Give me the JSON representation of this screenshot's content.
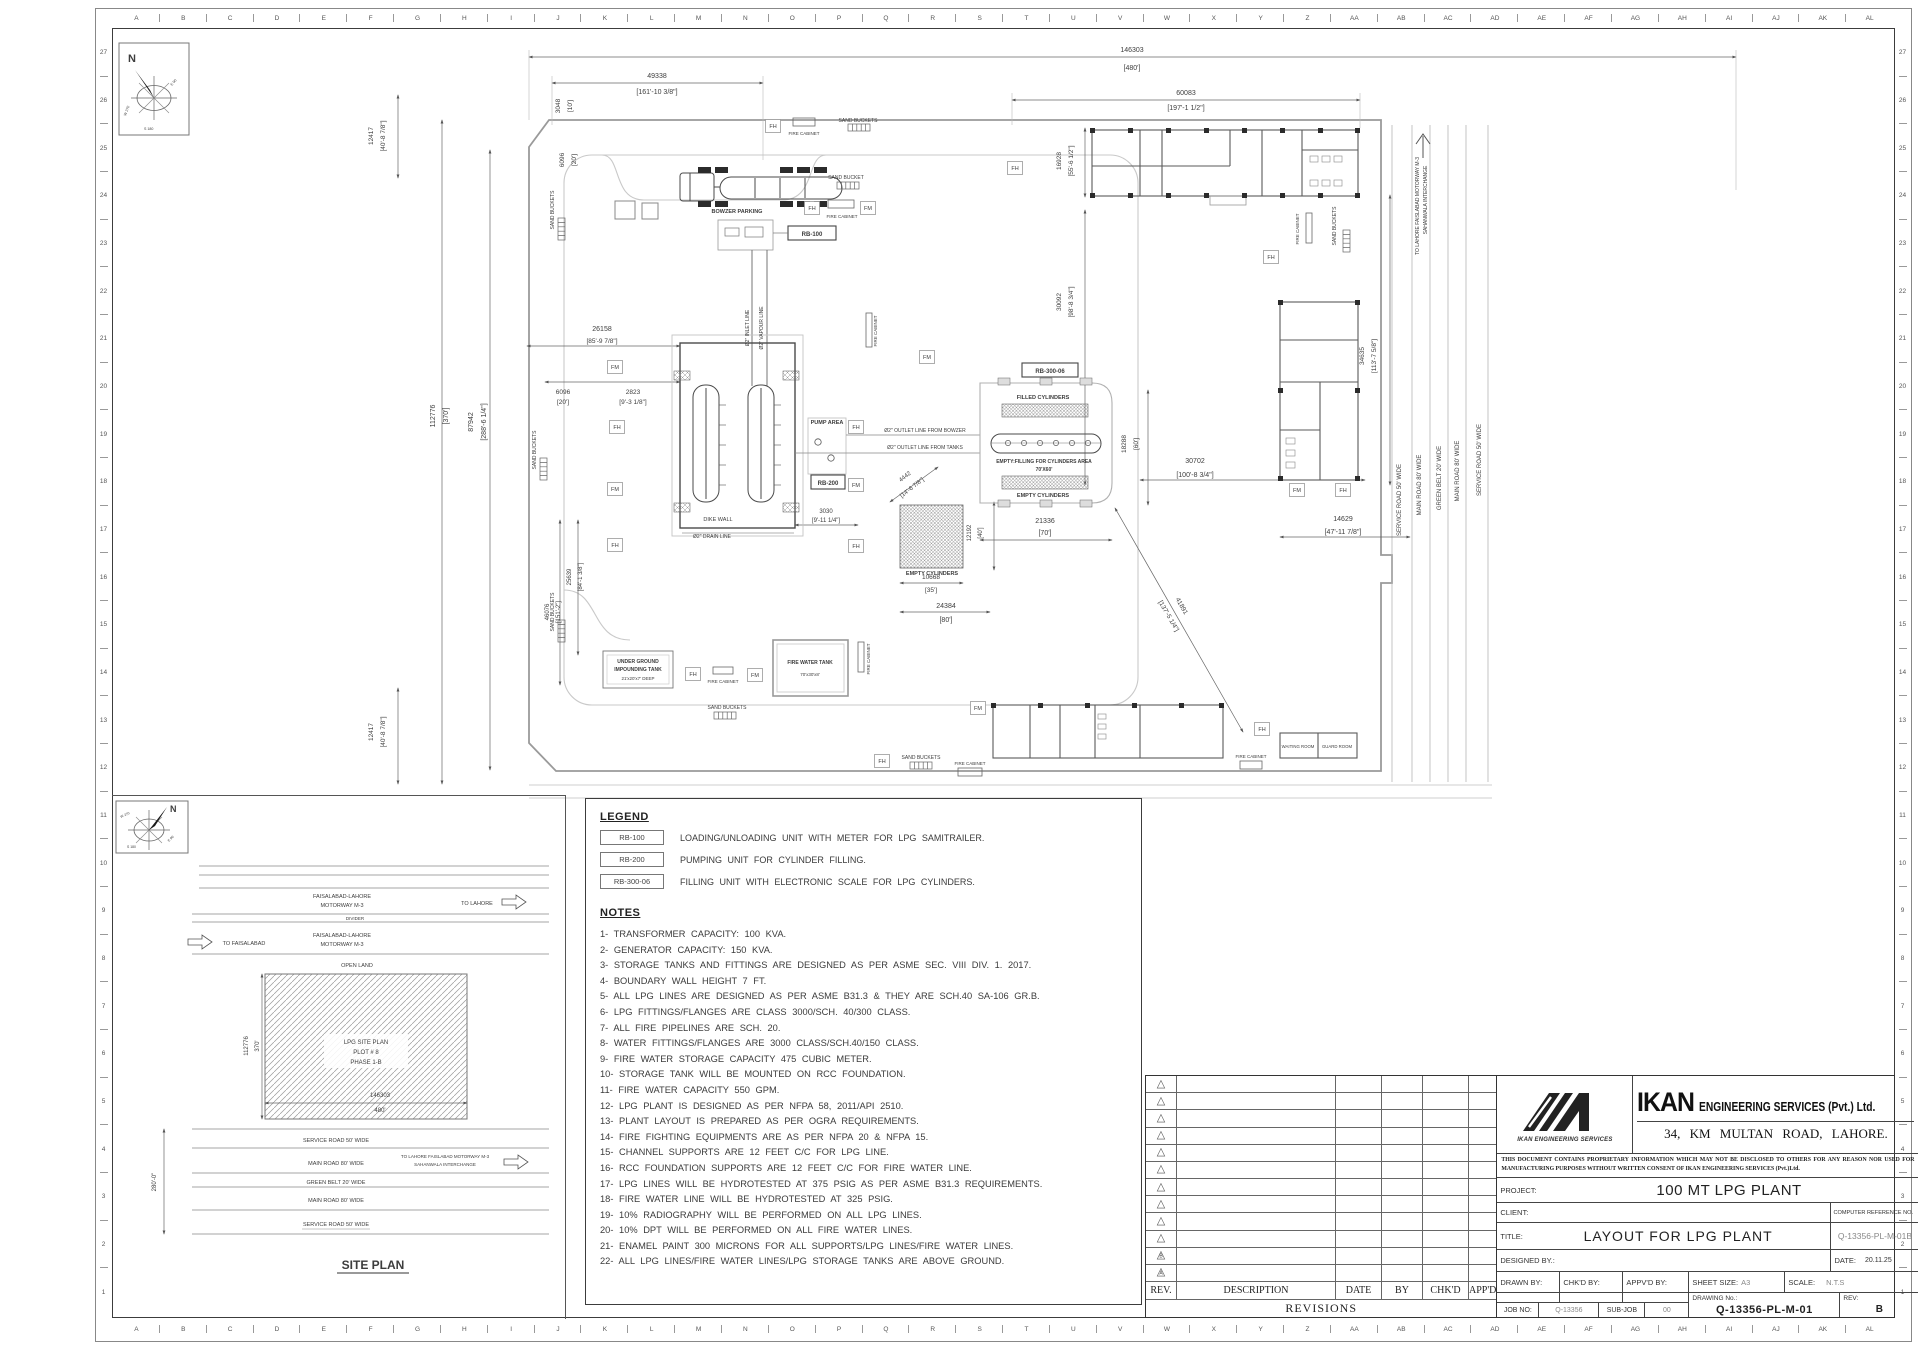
{
  "sheet": {
    "grid_letters": [
      "A",
      "B",
      "C",
      "D",
      "E",
      "F",
      "G",
      "H",
      "I",
      "J",
      "K",
      "L",
      "M",
      "N",
      "O",
      "P",
      "Q",
      "R",
      "S",
      "T",
      "U",
      "V",
      "W",
      "X",
      "Y",
      "Z",
      "AA",
      "AB",
      "AC",
      "AD",
      "AE",
      "AF",
      "AG",
      "AH",
      "AI",
      "AJ",
      "AK",
      "AL"
    ],
    "grid_numbers": [
      "27",
      "26",
      "25",
      "24",
      "23",
      "22",
      "21",
      "20",
      "19",
      "18",
      "17",
      "16",
      "15",
      "14",
      "13",
      "12",
      "11",
      "10",
      "9",
      "8",
      "7",
      "6",
      "5",
      "4",
      "3",
      "2",
      "1"
    ]
  },
  "compass": {
    "n": "N",
    "w": "W 270",
    "s": "S 180",
    "e": "E 90"
  },
  "legend": {
    "title": "LEGEND",
    "items": [
      {
        "code": "RB-100",
        "desc": "LOADING/UNLOADING UNIT WITH METER FOR LPG SAMITRAILER."
      },
      {
        "code": "RB-200",
        "desc": "PUMPING UNIT FOR CYLINDER FILLING."
      },
      {
        "code": "RB-300-06",
        "desc": "FILLING UNIT WITH ELECTRONIC SCALE FOR LPG CYLINDERS."
      }
    ]
  },
  "notes": {
    "title": "NOTES",
    "items": [
      "1-  TRANSFORMER  CAPACITY:  100  KVA.",
      "2-  GENERATOR  CAPACITY:  150  KVA.",
      "3-  STORAGE  TANKS  AND  FITTINGS  ARE  DESIGNED  AS  PER  ASME  SEC.  VIII  DIV.  1.  2017.",
      "4-  BOUNDARY  WALL  HEIGHT  7  FT.",
      "5-  ALL  LPG  LINES  ARE  DESIGNED  AS  PER  ASME  B31.3  &  THEY  ARE  SCH.40  SA-106  GR.B.",
      "6-  LPG  FITTINGS/FLANGES  ARE  CLASS  3000/SCH.  40/300  CLASS.",
      "7-  ALL  FIRE  PIPELINES  ARE  SCH.  20.",
      "8-  WATER  FITTINGS/FLANGES  ARE  3000  CLASS/SCH.40/150  CLASS.",
      "9-  FIRE  WATER  STORAGE  CAPACITY  475  CUBIC  METER.",
      "10-  STORAGE  TANK  WILL  BE  MOUNTED  ON  RCC  FOUNDATION.",
      "11-  FIRE  WATER  CAPACITY  550  GPM.",
      "12-  LPG  PLANT  IS  DESIGNED  AS  PER  NFPA  58,  2011/API  2510.",
      "13-  PLANT  LAYOUT  IS  PREPARED  AS  PER  OGRA  REQUIREMENTS.",
      "14-  FIRE  FIGHTING  EQUIPMENTS  ARE  AS  PER  NFPA  20  &  NFPA  15.",
      "15-  CHANNEL  SUPPORTS  ARE  12  FEET  C/C  FOR  LPG  LINE.",
      "16-  RCC  FOUNDATION  SUPPORTS  ARE  12  FEET  C/C  FOR  FIRE  WATER  LINE.",
      "17-  LPG  LINES  WILL  BE  HYDROTESTED  AT  375  PSIG  AS  PER  ASME  B31.3  REQUIREMENTS.",
      "18-  FIRE  WATER  LINE  WILL  BE  HYDROTESTED  AT  325  PSIG.",
      "19-  10%  RADIOGRAPHY  WILL  BE  PERFORMED  ON  ALL  LPG  LINES.",
      "20-  10%  DPT  WILL  BE  PERFORMED  ON  ALL  FIRE  WATER  LINES.",
      "21-  ENAMEL  PAINT  300  MICRONS  FOR  ALL  SUPPORTS/LPG  LINES/FIRE  WATER  LINES.",
      "22-  ALL  LPG  LINES/FIRE  WATER  LINES/LPG  STORAGE  TANKS  ARE  ABOVE  GROUND."
    ]
  },
  "revisions": {
    "caption": "REVISIONS",
    "headers": [
      "REV.",
      "DESCRIPTION",
      "DATE",
      "BY",
      "CHK'D",
      "APP'D"
    ],
    "rows": [
      "",
      "",
      "",
      "",
      "",
      "",
      "",
      "",
      "",
      "",
      "B",
      "A"
    ]
  },
  "title_block": {
    "company_strong": "IKAN",
    "company_rest": "ENGINEERING SERVICES (Pvt.) Ltd.",
    "logo_caption": "IKAN ENGINEERING SERVICES",
    "address": "34, KM MULTAN ROAD, LAHORE.",
    "disclaimer": "THIS DOCUMENT CONTAINS PROPRIETARY INFORMATION WHICH MAY NOT BE DISCLOSED TO OTHERS FOR ANY REASON NOR USED FOR MANUFACTURING PURPOSES WITHOUT WRITTEN CONSENT OF IKAN ENGINEERING SERVICES (Pvt.)Ltd.",
    "project_label": "PROJECT:",
    "project_value": "100 MT LPG PLANT",
    "client_label": "CLIENT:",
    "computer_ref_label": "COMPUTER REFERENCE NO.",
    "computer_ref_value": "Q-13356-PL-M-01B",
    "title_label": "TITLE:",
    "title_value": "LAYOUT FOR LPG PLANT",
    "designed_label": "DESIGNED BY.:",
    "date_label": "DATE:",
    "date_value": "20.11.25",
    "drawn_label": "DRAWN BY:",
    "chkd_label": "CHK'D BY:",
    "appvd_label": "APPV'D BY:",
    "sheet_size_label": "SHEET SIZE:",
    "sheet_size_value": "A3",
    "scale_label": "SCALE:",
    "scale_value": "N.T.S",
    "job_no_label": "JOB NO:",
    "job_no_value": "Q-13356",
    "sub_job_label": "SUB-JOB",
    "sub_job_value": "00",
    "drawing_no_label": "DRAWING No.:",
    "drawing_no_value": "Q-13356-PL-M-01",
    "rev_label": "REV:",
    "rev_value": "B"
  },
  "plan": {
    "texts": [
      {
        "t": "146303",
        "x": 782,
        "y": 22
      },
      {
        "t": "[480']",
        "x": 782,
        "y": 40
      },
      {
        "t": "49338",
        "x": 307,
        "y": 48
      },
      {
        "t": "[161'-10 3/8\"]",
        "x": 307,
        "y": 64
      },
      {
        "t": "60083",
        "x": 836,
        "y": 65
      },
      {
        "t": "[197'-1 1/2\"]",
        "x": 836,
        "y": 80
      },
      {
        "t": "3048",
        "x": 210,
        "y": 76,
        "r": -90,
        "s": 6.5
      },
      {
        "t": "[10']",
        "x": 222,
        "y": 76,
        "r": -90,
        "s": 6.5
      },
      {
        "t": "6096",
        "x": 214,
        "y": 130,
        "r": -90,
        "s": 6.5
      },
      {
        "t": "[20']",
        "x": 226,
        "y": 130,
        "r": -90,
        "s": 6.5
      },
      {
        "t": "12417",
        "x": 23,
        "y": 106,
        "r": -90,
        "s": 6.5
      },
      {
        "t": "[40'-8 7/8\"]",
        "x": 35,
        "y": 106,
        "r": -90,
        "s": 6.5
      },
      {
        "t": "112776",
        "x": 85,
        "y": 386,
        "r": -90
      },
      {
        "t": "[370']",
        "x": 98,
        "y": 386,
        "r": -90
      },
      {
        "t": "87942",
        "x": 123,
        "y": 392,
        "r": -90
      },
      {
        "t": "[288'-6 1/4\"]",
        "x": 136,
        "y": 392,
        "r": -90
      },
      {
        "t": "16928",
        "x": 711,
        "y": 131,
        "r": -90,
        "s": 6.5
      },
      {
        "t": "[55'-6 1/2\"]",
        "x": 723,
        "y": 131,
        "r": -90,
        "s": 6.5
      },
      {
        "t": "30092",
        "x": 711,
        "y": 272,
        "r": -90,
        "s": 6.5
      },
      {
        "t": "[98'-8 3/4\"]",
        "x": 723,
        "y": 272,
        "r": -90,
        "s": 6.5
      },
      {
        "t": "26158",
        "x": 252,
        "y": 301
      },
      {
        "t": "[85'-9 7/8\"]",
        "x": 252,
        "y": 313,
        "s": 6.5
      },
      {
        "t": "6096",
        "x": 213,
        "y": 364,
        "s": 6.5
      },
      {
        "t": "[20']",
        "x": 213,
        "y": 374,
        "s": 6.5
      },
      {
        "t": "2823",
        "x": 283,
        "y": 364,
        "s": 6.5
      },
      {
        "t": "[9'-3 1/8\"]",
        "x": 283,
        "y": 374,
        "s": 6.5
      },
      {
        "t": "46076",
        "x": 199,
        "y": 582,
        "r": -90,
        "s": 6
      },
      {
        "t": "[151'-2\"]",
        "x": 210,
        "y": 582,
        "r": -90,
        "s": 6
      },
      {
        "t": "25639",
        "x": 221,
        "y": 547,
        "r": -90,
        "s": 6
      },
      {
        "t": "[84'-1 3/8\"]",
        "x": 232,
        "y": 547,
        "r": -90,
        "s": 6
      },
      {
        "t": "12417",
        "x": 23,
        "y": 702,
        "r": -90,
        "s": 6.5
      },
      {
        "t": "[40'-8 7/8\"]",
        "x": 35,
        "y": 702,
        "r": -90,
        "s": 6.5
      },
      {
        "t": "34635",
        "x": 1014,
        "y": 326,
        "r": -90,
        "s": 6.5
      },
      {
        "t": "[113'-7 5/8\"]",
        "x": 1026,
        "y": 326,
        "r": -90,
        "s": 6.5
      },
      {
        "t": "18288",
        "x": 776,
        "y": 414,
        "r": -90,
        "s": 6.5
      },
      {
        "t": "[60']",
        "x": 788,
        "y": 414,
        "r": -90,
        "s": 6.5
      },
      {
        "t": "30702",
        "x": 845,
        "y": 433
      },
      {
        "t": "[100'-8 3/4\"]",
        "x": 845,
        "y": 447
      },
      {
        "t": "21336",
        "x": 695,
        "y": 493
      },
      {
        "t": "[70']",
        "x": 695,
        "y": 505
      },
      {
        "t": "14629",
        "x": 993,
        "y": 491
      },
      {
        "t": "[47'-11 7/8\"]",
        "x": 993,
        "y": 504
      },
      {
        "t": "10668",
        "x": 581,
        "y": 549,
        "s": 6.5
      },
      {
        "t": "[35']",
        "x": 581,
        "y": 562,
        "s": 6.5
      },
      {
        "t": "24384",
        "x": 596,
        "y": 578
      },
      {
        "t": "[80']",
        "x": 596,
        "y": 592
      },
      {
        "t": "12192",
        "x": 621,
        "y": 503,
        "r": -90,
        "s": 6
      },
      {
        "t": "[40']",
        "x": 632,
        "y": 503,
        "r": -90,
        "s": 6
      },
      {
        "t": "4442",
        "x": 556,
        "y": 448,
        "r": -38,
        "s": 6
      },
      {
        "t": "[14'-6 7/8\"]",
        "x": 563,
        "y": 459,
        "r": -38,
        "s": 6
      },
      {
        "t": "3030",
        "x": 476,
        "y": 483,
        "s": 6
      },
      {
        "t": "[9'-11 1/4\"]",
        "x": 476,
        "y": 492,
        "s": 6
      },
      {
        "t": "41891",
        "x": 830,
        "y": 577,
        "r": 60,
        "s": 6.5
      },
      {
        "t": "[137'-5 1/4\"]",
        "x": 817,
        "y": 587,
        "r": 60,
        "s": 6.5
      },
      {
        "t": "BOWZER PARKING",
        "x": 387,
        "y": 183,
        "s": 5.5,
        "b": 1
      },
      {
        "t": "RB-100",
        "x": 462,
        "y": 206,
        "s": 6,
        "b": 1
      },
      {
        "t": "RB-200",
        "x": 478,
        "y": 455,
        "s": 6,
        "b": 1
      },
      {
        "t": "RB-300-06",
        "x": 700,
        "y": 343,
        "s": 6,
        "b": 1
      },
      {
        "t": "PUMP AREA",
        "x": 477,
        "y": 394,
        "s": 5.5,
        "b": 1
      },
      {
        "t": "Ø2\" OUTLET LINE FROM BOWZER",
        "x": 575,
        "y": 402,
        "s": 5
      },
      {
        "t": "Ø2\" OUTLET LINE FROM TANKS",
        "x": 575,
        "y": 419,
        "s": 5
      },
      {
        "t": "Ø2\" INLET LINE",
        "x": 399,
        "y": 298,
        "r": -90,
        "s": 5
      },
      {
        "t": "Ø2\" VAPOUR LINE",
        "x": 413,
        "y": 298,
        "r": -90,
        "s": 5
      },
      {
        "t": "Ø2\" DRAIN LINE",
        "x": 362,
        "y": 508,
        "s": 5
      },
      {
        "t": "DIKE WALL",
        "x": 368,
        "y": 491,
        "s": 5.5
      },
      {
        "t": "FILLED CYLINDERS",
        "x": 693,
        "y": 369,
        "s": 5.5,
        "b": 1
      },
      {
        "t": "EMPTY:FILLING FOR CYLINDERS AREA",
        "x": 694,
        "y": 433,
        "s": 5,
        "b": 1
      },
      {
        "t": "70'X60'",
        "x": 694,
        "y": 441,
        "s": 5,
        "b": 1
      },
      {
        "t": "EMPTY CYLINDERS",
        "x": 693,
        "y": 467,
        "s": 5.5,
        "b": 1
      },
      {
        "t": "EMPTY CYLINDERS",
        "x": 582,
        "y": 545,
        "s": 5.5,
        "b": 1
      },
      {
        "t": "UNDER GROUND",
        "x": 288,
        "y": 633,
        "s": 5,
        "b": 1
      },
      {
        "t": "IMPOUNDING TANK",
        "x": 288,
        "y": 641,
        "s": 5,
        "b": 1
      },
      {
        "t": "21'x20'x7' DEEP",
        "x": 288,
        "y": 650,
        "s": 4.5
      },
      {
        "t": "FIRE WATER TANK",
        "x": 460,
        "y": 634,
        "s": 5,
        "b": 1
      },
      {
        "t": "70'x30'x8'",
        "x": 460,
        "y": 646,
        "s": 4.5
      },
      {
        "t": "WAITING ROOM",
        "x": 948,
        "y": 718,
        "s": 4.3
      },
      {
        "t": "GUARD ROOM",
        "x": 987,
        "y": 718,
        "s": 4.3
      },
      {
        "t": "SAND BUCKET",
        "x": 496,
        "y": 149,
        "s": 5
      },
      {
        "t": "SAND BUCKETS",
        "x": 508,
        "y": 92,
        "s": 5
      },
      {
        "t": "SAND BUCKETS",
        "x": 377,
        "y": 679,
        "s": 5
      },
      {
        "t": "SAND BUCKETS",
        "x": 571,
        "y": 729,
        "s": 5
      },
      {
        "t": "SAND BUCKETS",
        "x": 204,
        "y": 180,
        "r": -90,
        "s": 5
      },
      {
        "t": "SAND BUCKETS",
        "x": 186,
        "y": 420,
        "r": -90,
        "s": 5
      },
      {
        "t": "SAND BUCKETS",
        "x": 204,
        "y": 582,
        "r": -90,
        "s": 5
      },
      {
        "t": "SAND BUCKETS",
        "x": 986,
        "y": 196,
        "r": -90,
        "s": 5
      },
      {
        "t": "FIRE CABINET",
        "x": 454,
        "y": 105,
        "s": 4.5
      },
      {
        "t": "FIRE CABINET",
        "x": 492,
        "y": 188,
        "s": 4.5
      },
      {
        "t": "FIRE CABINET",
        "x": 373,
        "y": 653,
        "s": 4.5
      },
      {
        "t": "FIRE CABINET",
        "x": 620,
        "y": 735,
        "s": 4.5
      },
      {
        "t": "FIRE CABINET",
        "x": 901,
        "y": 728,
        "s": 4.5
      },
      {
        "t": "FIRE CABINET",
        "x": 527,
        "y": 301,
        "r": -90,
        "s": 4.5
      },
      {
        "t": "FIRE CABINET",
        "x": 520,
        "y": 629,
        "r": -90,
        "s": 4.5
      },
      {
        "t": "FIRE CABINET",
        "x": 949,
        "y": 199,
        "r": -90,
        "s": 4.5
      },
      {
        "t": "SERVICE ROAD 50' WIDE",
        "x": 1051,
        "y": 470,
        "r": -90,
        "s": 6
      },
      {
        "t": "MAIN ROAD 80' WIDE",
        "x": 1071,
        "y": 455,
        "r": -90,
        "s": 6
      },
      {
        "t": "GREEN BELT 20' WIDE",
        "x": 1091,
        "y": 448,
        "r": -90,
        "s": 6
      },
      {
        "t": "MAIN ROAD 80' WIDE",
        "x": 1109,
        "y": 441,
        "r": -90,
        "s": 6
      },
      {
        "t": "SERVICE ROAD 50' WIDE",
        "x": 1131,
        "y": 430,
        "r": -90,
        "s": 6
      },
      {
        "t": "TO LAHORE FAISLABAD MOTORWAY M-3",
        "x": 1069,
        "y": 176,
        "r": -90,
        "s": 5
      },
      {
        "t": "SAHANWALA INTERCHANGE",
        "x": 1077,
        "y": 170,
        "r": -90,
        "s": 5
      }
    ],
    "markers": [
      {
        "t": "FH",
        "x": 423,
        "y": 96
      },
      {
        "t": "FH",
        "x": 665,
        "y": 138
      },
      {
        "t": "FH",
        "x": 921,
        "y": 227
      },
      {
        "t": "FH",
        "x": 462,
        "y": 178
      },
      {
        "t": "FH",
        "x": 267,
        "y": 397
      },
      {
        "t": "FH",
        "x": 506,
        "y": 397
      },
      {
        "t": "FH",
        "x": 506,
        "y": 516
      },
      {
        "t": "FH",
        "x": 265,
        "y": 515
      },
      {
        "t": "FH",
        "x": 343,
        "y": 644
      },
      {
        "t": "FH",
        "x": 532,
        "y": 731
      },
      {
        "t": "FH",
        "x": 912,
        "y": 699
      },
      {
        "t": "FH",
        "x": 993,
        "y": 460
      },
      {
        "t": "FM",
        "x": 518,
        "y": 178
      },
      {
        "t": "FM",
        "x": 265,
        "y": 337
      },
      {
        "t": "FM",
        "x": 265,
        "y": 459
      },
      {
        "t": "FM",
        "x": 506,
        "y": 455
      },
      {
        "t": "FM",
        "x": 577,
        "y": 327
      },
      {
        "t": "FM",
        "x": 947,
        "y": 460
      },
      {
        "t": "FM",
        "x": 405,
        "y": 645
      },
      {
        "t": "FM",
        "x": 628,
        "y": 678
      }
    ]
  },
  "site": {
    "title": "SITE PLAN",
    "texts": [
      {
        "t": "FAISALABAD-LAHORE",
        "x": 230,
        "y": 102,
        "s": 5.5
      },
      {
        "t": "MOTORWAY M-3",
        "x": 230,
        "y": 111,
        "s": 5.5
      },
      {
        "t": "TO LAHORE",
        "x": 365,
        "y": 109,
        "s": 5.5
      },
      {
        "t": "DIVIDER",
        "x": 243,
        "y": 124,
        "s": 4.5
      },
      {
        "t": "FAISALABAD-LAHORE",
        "x": 230,
        "y": 141,
        "s": 5.5
      },
      {
        "t": "MOTORWAY M-3",
        "x": 230,
        "y": 150,
        "s": 5.5
      },
      {
        "t": "TO FAISALABAD",
        "x": 132,
        "y": 149,
        "s": 5.5
      },
      {
        "t": "OPEN LAND",
        "x": 245,
        "y": 171,
        "s": 5.5
      },
      {
        "t": "LPG SITE PLAN",
        "x": 254,
        "y": 248,
        "s": 6
      },
      {
        "t": "PLOT # 8",
        "x": 254,
        "y": 258,
        "s": 6
      },
      {
        "t": "PHASE 1-B",
        "x": 254,
        "y": 268,
        "s": 6
      },
      {
        "t": "112776",
        "x": 136,
        "y": 250,
        "r": -90,
        "s": 6
      },
      {
        "t": "370'",
        "x": 147,
        "y": 250,
        "r": -90,
        "s": 6
      },
      {
        "t": "146303",
        "x": 268,
        "y": 301,
        "s": 6
      },
      {
        "t": "480'",
        "x": 268,
        "y": 316,
        "s": 6
      },
      {
        "t": "SERVICE ROAD 50' WIDE",
        "x": 224,
        "y": 346,
        "s": 5.5
      },
      {
        "t": "MAIN ROAD 80' WIDE",
        "x": 224,
        "y": 369,
        "s": 5.5
      },
      {
        "t": "TO LAHORE FAISLABAD MOTORWAY M-3",
        "x": 333,
        "y": 362,
        "s": 4.5
      },
      {
        "t": "SAHANWALA INTERCHANGE",
        "x": 333,
        "y": 370,
        "s": 4.5
      },
      {
        "t": "GREEN BELT 20' WIDE",
        "x": 224,
        "y": 388,
        "s": 5.5
      },
      {
        "t": "MAIN ROAD 80' WIDE",
        "x": 224,
        "y": 406,
        "s": 5.5
      },
      {
        "t": "SERVICE ROAD 50' WIDE",
        "x": 224,
        "y": 430,
        "s": 5.5
      },
      {
        "t": "280'-0\"",
        "x": 44,
        "y": 386,
        "r": -90,
        "s": 6
      },
      {
        "t": "SITE PLAN",
        "x": 261,
        "y": 473,
        "s": 12,
        "b": 1
      }
    ]
  }
}
